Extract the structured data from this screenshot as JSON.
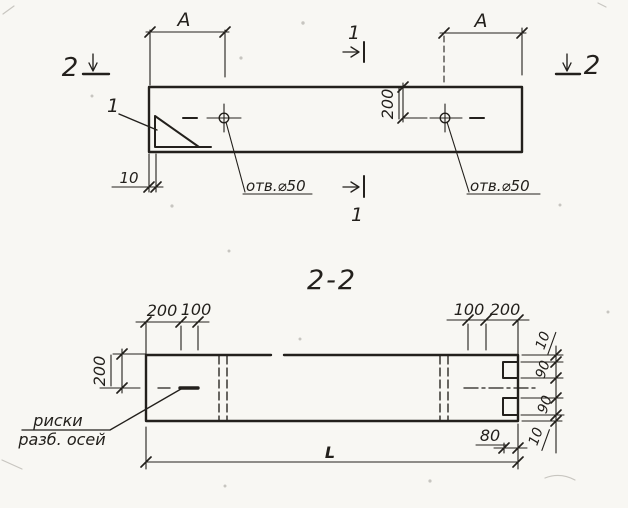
{
  "colors": {
    "paper": "#f8f7f3",
    "ink": "#23201c"
  },
  "plan_view": {
    "section_cut_top_label": "1",
    "section_cut_bottom_label": "1",
    "section_cut_left_label": "2",
    "section_cut_right_label": "2",
    "detail_callout_label": "1",
    "dim_a_left": "A",
    "dim_a_right": "A",
    "dim_hole_offset": "200",
    "dim_end_inset": "10",
    "hole_label_left": "отв.⌀50",
    "hole_label_right": "отв.⌀50"
  },
  "section_view": {
    "title": "2-2",
    "dim_top_left_200": "200",
    "dim_top_left_100": "100",
    "dim_top_right_100": "100",
    "dim_top_right_200": "200",
    "dim_left_height": "200",
    "dim_right_top_10": "10",
    "dim_right_top_90": "90",
    "dim_right_bottom_90": "90",
    "dim_right_bottom_10": "10",
    "dim_notch_80": "80",
    "dim_overall_length": "L",
    "axis_label_line1": "риски",
    "axis_label_line2": "разб. осей"
  }
}
